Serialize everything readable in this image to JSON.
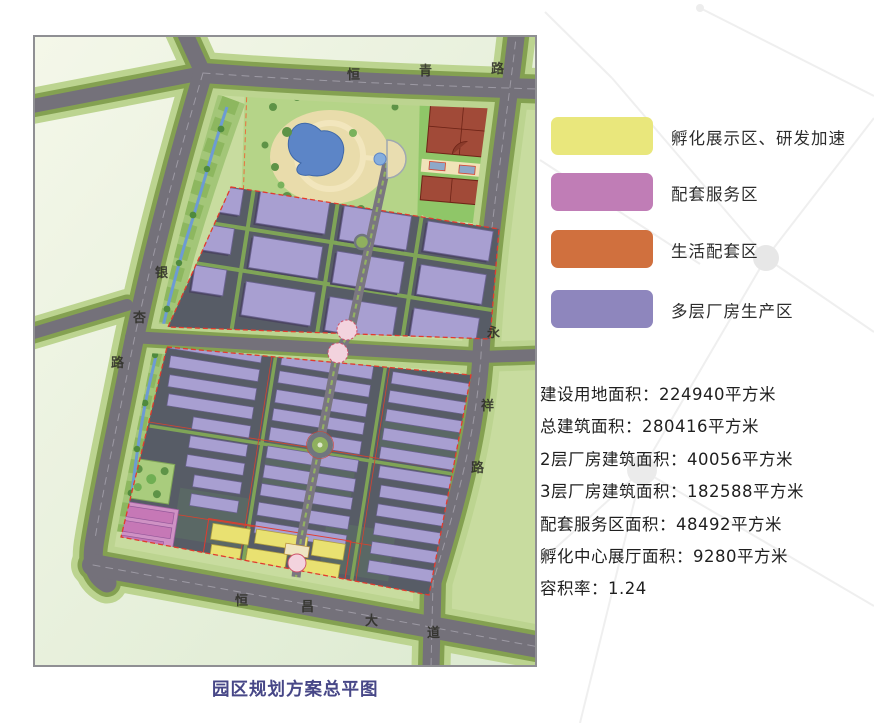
{
  "map": {
    "caption": "园区规划方案总平图",
    "roads": {
      "north": "恒青路",
      "west": "银杏路",
      "east": "永祥路",
      "south": "恒昌大道"
    }
  },
  "legend": {
    "items": [
      {
        "label": "孵化展示区、研发加速",
        "color": "#e9e77c"
      },
      {
        "label": "配套服务区",
        "color": "#c07db6"
      },
      {
        "label": "生活配套区",
        "color": "#d0703e"
      },
      {
        "label": "多层厂房生产区",
        "color": "#8e86bd"
      }
    ]
  },
  "stats": {
    "lines": [
      "建设用地面积：224940平方米",
      "总建筑面积：280416平方米",
      "2层厂房建筑面积：40056平方米",
      "3层厂房建筑面积：182588平方米",
      "配套服务区面积：48492平方米",
      "孵化中心展厅面积：9280平方米",
      "容积率：1.24"
    ]
  }
}
